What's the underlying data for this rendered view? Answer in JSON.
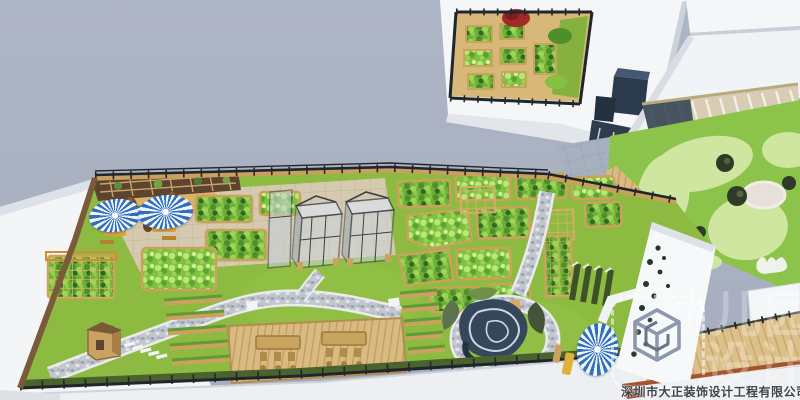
{
  "image": {
    "kind": "3d-render",
    "subject": "rooftop-kindergarten-garden-plan"
  },
  "watermark": {
    "company": "深圳市大正装饰设计工程有限公司",
    "brand_line1": "幼儿园",
    "brand_line2": "设计",
    "logo": "wireframe-cube-logo"
  },
  "colors": {
    "sky": "#a9b1c2",
    "building_white": "#f4f6f8",
    "building_shade": "#dfe3e8",
    "navy_block": "#2c3a4e",
    "lawn": "#8dbb41",
    "play_lawn": "#8cc34a",
    "play_blob": "#cfe6a1",
    "wood": "#cda05f",
    "deck": "#d9ba80",
    "paving": "#d5c9b0",
    "gray_paving": "#a7b0bf",
    "pebble_path": "#c2c6ce",
    "sand": "#ddb06c",
    "fence": "#20262c",
    "hedge": "#49622e",
    "track_red": "#a2542f",
    "umbrella_blue": "#2f6fbe",
    "sculpture_navy": "#35475a",
    "veg_green": "#6fae38",
    "red_tree": "#a32828"
  },
  "scene_elements": [
    "upper-fenced-vegetable-garden",
    "right-playground-lawn",
    "pergola-terrace",
    "main-roof-garden",
    "patio-with-umbrellas",
    "glass-greenhouses",
    "raised-planting-beds",
    "pebble-winding-path",
    "wooden-deck-with-tables",
    "planter-frame-rows",
    "wooden-kiosk",
    "snail-sculpture-mound",
    "perimeter-fence",
    "running-track-deck"
  ]
}
